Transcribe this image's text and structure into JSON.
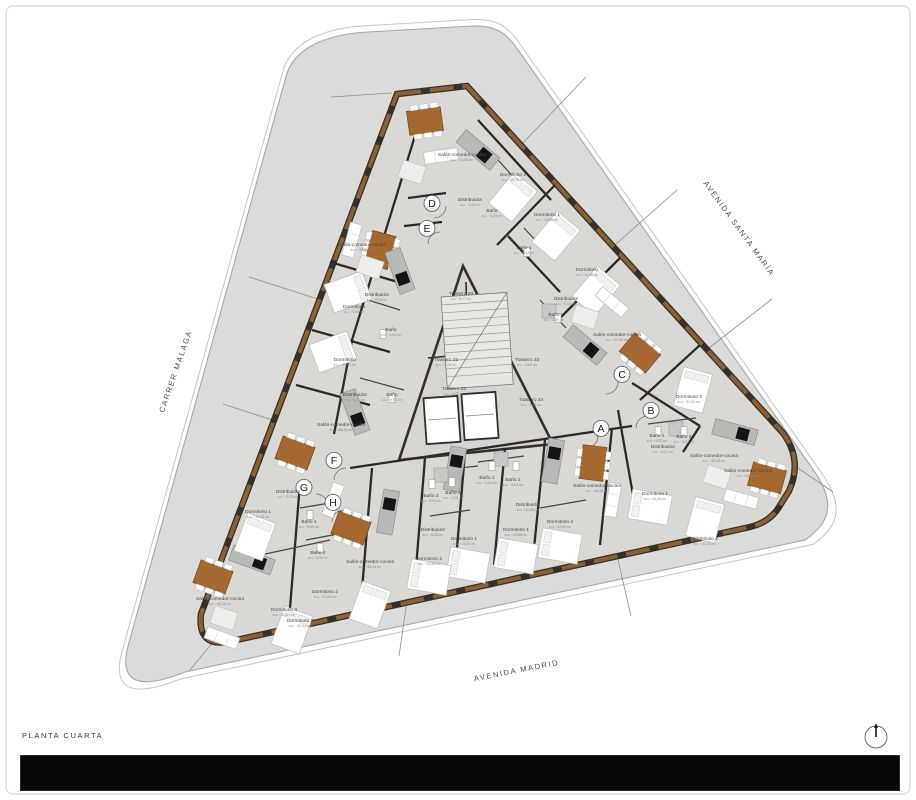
{
  "footer": {
    "floor_label": "PLANTA CUARTA"
  },
  "compass": {
    "name": "north-indicator"
  },
  "colors": {
    "site_gray": "#dbdbd9",
    "building_gray": "#d9d8d5",
    "wall_dark": "#35302a",
    "wall_brown": "#8a6134",
    "table_brown": "#a5692f",
    "island_gray": "#b9b9b7",
    "cooktop_black": "#141414",
    "footer_black": "#060606"
  },
  "streets": [
    {
      "name": "CARRER MALAGA",
      "x": 178,
      "y": 372,
      "rot": -71
    },
    {
      "name": "AVENIDA SANTA MARÍA",
      "x": 737,
      "y": 230,
      "rot": 54
    },
    {
      "name": "AVENIDA MADRID",
      "x": 517,
      "y": 673,
      "rot": -11
    }
  ],
  "plan": {
    "unit_letters": [
      {
        "letter": "A",
        "x": 601,
        "y": 432
      },
      {
        "letter": "B",
        "x": 651,
        "y": 414
      },
      {
        "letter": "C",
        "x": 622,
        "y": 378
      },
      {
        "letter": "D",
        "x": 432,
        "y": 207
      },
      {
        "letter": "E",
        "x": 427,
        "y": 232
      },
      {
        "letter": "F",
        "x": 334,
        "y": 464
      },
      {
        "letter": "G",
        "x": 304,
        "y": 491
      },
      {
        "letter": "H",
        "x": 333,
        "y": 506
      }
    ],
    "room_labels": [
      {
        "text": "Salón-comedor-cocina",
        "area": "s.u. ~44,85 m²",
        "x": 462,
        "y": 156
      },
      {
        "text": "Dormitorio 2",
        "area": "s.u. ~10,75 m²",
        "x": 513,
        "y": 176
      },
      {
        "text": "Distribuidor",
        "area": "s.u. ~7,03 m²",
        "x": 470,
        "y": 201
      },
      {
        "text": "Baño",
        "area": "s.u. ~4,09 m²",
        "x": 492,
        "y": 212
      },
      {
        "text": "Dormitorio 1",
        "area": "s.u. ~12,86 m²",
        "x": 547,
        "y": 216
      },
      {
        "text": "Baño 1",
        "area": "s.u. ~6,12 m²",
        "x": 524,
        "y": 249
      },
      {
        "text": "Dormitorio",
        "area": "s.u. ~11,48 m²",
        "x": 587,
        "y": 271
      },
      {
        "text": "Distribuidor",
        "area": "s.u. ~5,08 m²",
        "x": 566,
        "y": 300
      },
      {
        "text": "Baño",
        "area": "s.u. ~4,05 m²",
        "x": 554,
        "y": 316
      },
      {
        "text": "Salón-comedor-cocina",
        "area": "s.u. ~57,96 m²",
        "x": 617,
        "y": 336
      },
      {
        "text": "Salón-comedor-cocina",
        "area": "s.u. ~48,34 m²",
        "x": 362,
        "y": 246
      },
      {
        "text": "Distribuidor",
        "area": "s.u. ~6,06 m²",
        "x": 377,
        "y": 296
      },
      {
        "text": "Dormitorio",
        "area": "s.u. ~9,56 m²",
        "x": 354,
        "y": 308
      },
      {
        "text": "Baño",
        "area": "s.u. ~4,06 m²",
        "x": 391,
        "y": 331
      },
      {
        "text": "Dormitorio",
        "area": "s.u. ~10,61 m²",
        "x": 345,
        "y": 361
      },
      {
        "text": "Distribuidor",
        "area": "s.u. ~4,21 m²",
        "x": 355,
        "y": 396
      },
      {
        "text": "Baño",
        "area": "s.u. ~4,02 m²",
        "x": 392,
        "y": 396
      },
      {
        "text": "Salón-comedor-cocina",
        "area": "s.u. ~48,45 m²",
        "x": 341,
        "y": 426
      },
      {
        "text": "Trastero 30",
        "area": "s.u. ~5,77 m²",
        "x": 461,
        "y": 295
      },
      {
        "text": "Trastero 31",
        "area": "s.u. ~4,54 m²",
        "x": 446,
        "y": 361
      },
      {
        "text": "Trastero 33",
        "area": "s.u. ~4,63 m²",
        "x": 527,
        "y": 361
      },
      {
        "text": "Trastero 32",
        "area": "s.u. ~4,80 m²",
        "x": 454,
        "y": 390
      },
      {
        "text": "Trastero 34",
        "area": "s.u. ~4,16 m²",
        "x": 531,
        "y": 401
      },
      {
        "text": "Dormitorio 2",
        "area": "s.u. ~11,02 m²",
        "x": 689,
        "y": 398
      },
      {
        "text": "Baño 1",
        "area": "s.u. ~4,02 m²",
        "x": 657,
        "y": 437
      },
      {
        "text": "Baño 2",
        "area": "s.u. ~4,02 m²",
        "x": 684,
        "y": 438
      },
      {
        "text": "Distribuidor",
        "area": "s.u. ~6,21 m²",
        "x": 663,
        "y": 448
      },
      {
        "text": "Salón-comedor-cocina",
        "area": "s.u. ~46,48 m²",
        "x": 714,
        "y": 457
      },
      {
        "text": "Dormitorio 1",
        "area": "s.u. ~13,26 m²",
        "x": 655,
        "y": 495
      },
      {
        "text": "Salón-comedor-cocina",
        "area": "s.u. ~48,08 m²",
        "x": 597,
        "y": 487
      },
      {
        "text": "Dormitorio 1",
        "area": "s.u. ~12,24 m²",
        "x": 705,
        "y": 540
      },
      {
        "text": "Baño 1",
        "area": "s.u. ~4,04 m²",
        "x": 487,
        "y": 479
      },
      {
        "text": "Baño 2",
        "area": "s.u. ~4,04 m²",
        "x": 513,
        "y": 481
      },
      {
        "text": "Baño 1",
        "area": "s.u. ~4,08 m²",
        "x": 453,
        "y": 494
      },
      {
        "text": "Baño 2",
        "area": "s.u. ~3,94 m²",
        "x": 431,
        "y": 497
      },
      {
        "text": "Distribuidor",
        "area": "s.u. ~10,08 m²",
        "x": 528,
        "y": 506
      },
      {
        "text": "Dormitorio 2",
        "area": "s.u. ~12,59 m²",
        "x": 560,
        "y": 523
      },
      {
        "text": "Dormitorio 1",
        "area": "s.u. ~13,68 m²",
        "x": 516,
        "y": 531
      },
      {
        "text": "Distribuidor",
        "area": "s.u. ~6,28 m²",
        "x": 433,
        "y": 531
      },
      {
        "text": "Dormitorio 1",
        "area": "s.u. ~13,66 m²",
        "x": 464,
        "y": 540
      },
      {
        "text": "Dormitorio 2",
        "area": "s.u. ~12,56 m²",
        "x": 429,
        "y": 560
      },
      {
        "text": "Distribuidor",
        "area": "s.u. ~9,21 m²",
        "x": 288,
        "y": 493
      },
      {
        "text": "Dormitorio 1",
        "area": "s.u. ~11,56 m²",
        "x": 258,
        "y": 513
      },
      {
        "text": "Baño 1",
        "area": "s.u. ~5,06 m²",
        "x": 309,
        "y": 523
      },
      {
        "text": "Baño 2",
        "area": "s.u. ~3,94 m²",
        "x": 318,
        "y": 554
      },
      {
        "text": "Salón-comedor-cocina",
        "area": "s.u. ~48,16 m²",
        "x": 370,
        "y": 563
      },
      {
        "text": "Dormitorio 2",
        "area": "s.u. ~11,06 m²",
        "x": 325,
        "y": 593
      },
      {
        "text": "Salón-comedor-cocina",
        "area": "s.u. ~48,16 m²",
        "x": 220,
        "y": 600
      },
      {
        "text": "Dormitorio 3",
        "area": "s.u. ~10,61 m²",
        "x": 284,
        "y": 611
      },
      {
        "text": "Dormitorio 3",
        "area": "s.u. ~10,34 m²",
        "x": 300,
        "y": 622
      },
      {
        "text": "Salón-comedor-cocina",
        "area": "s.u. ~46,48 m²",
        "x": 748,
        "y": 472
      }
    ]
  }
}
